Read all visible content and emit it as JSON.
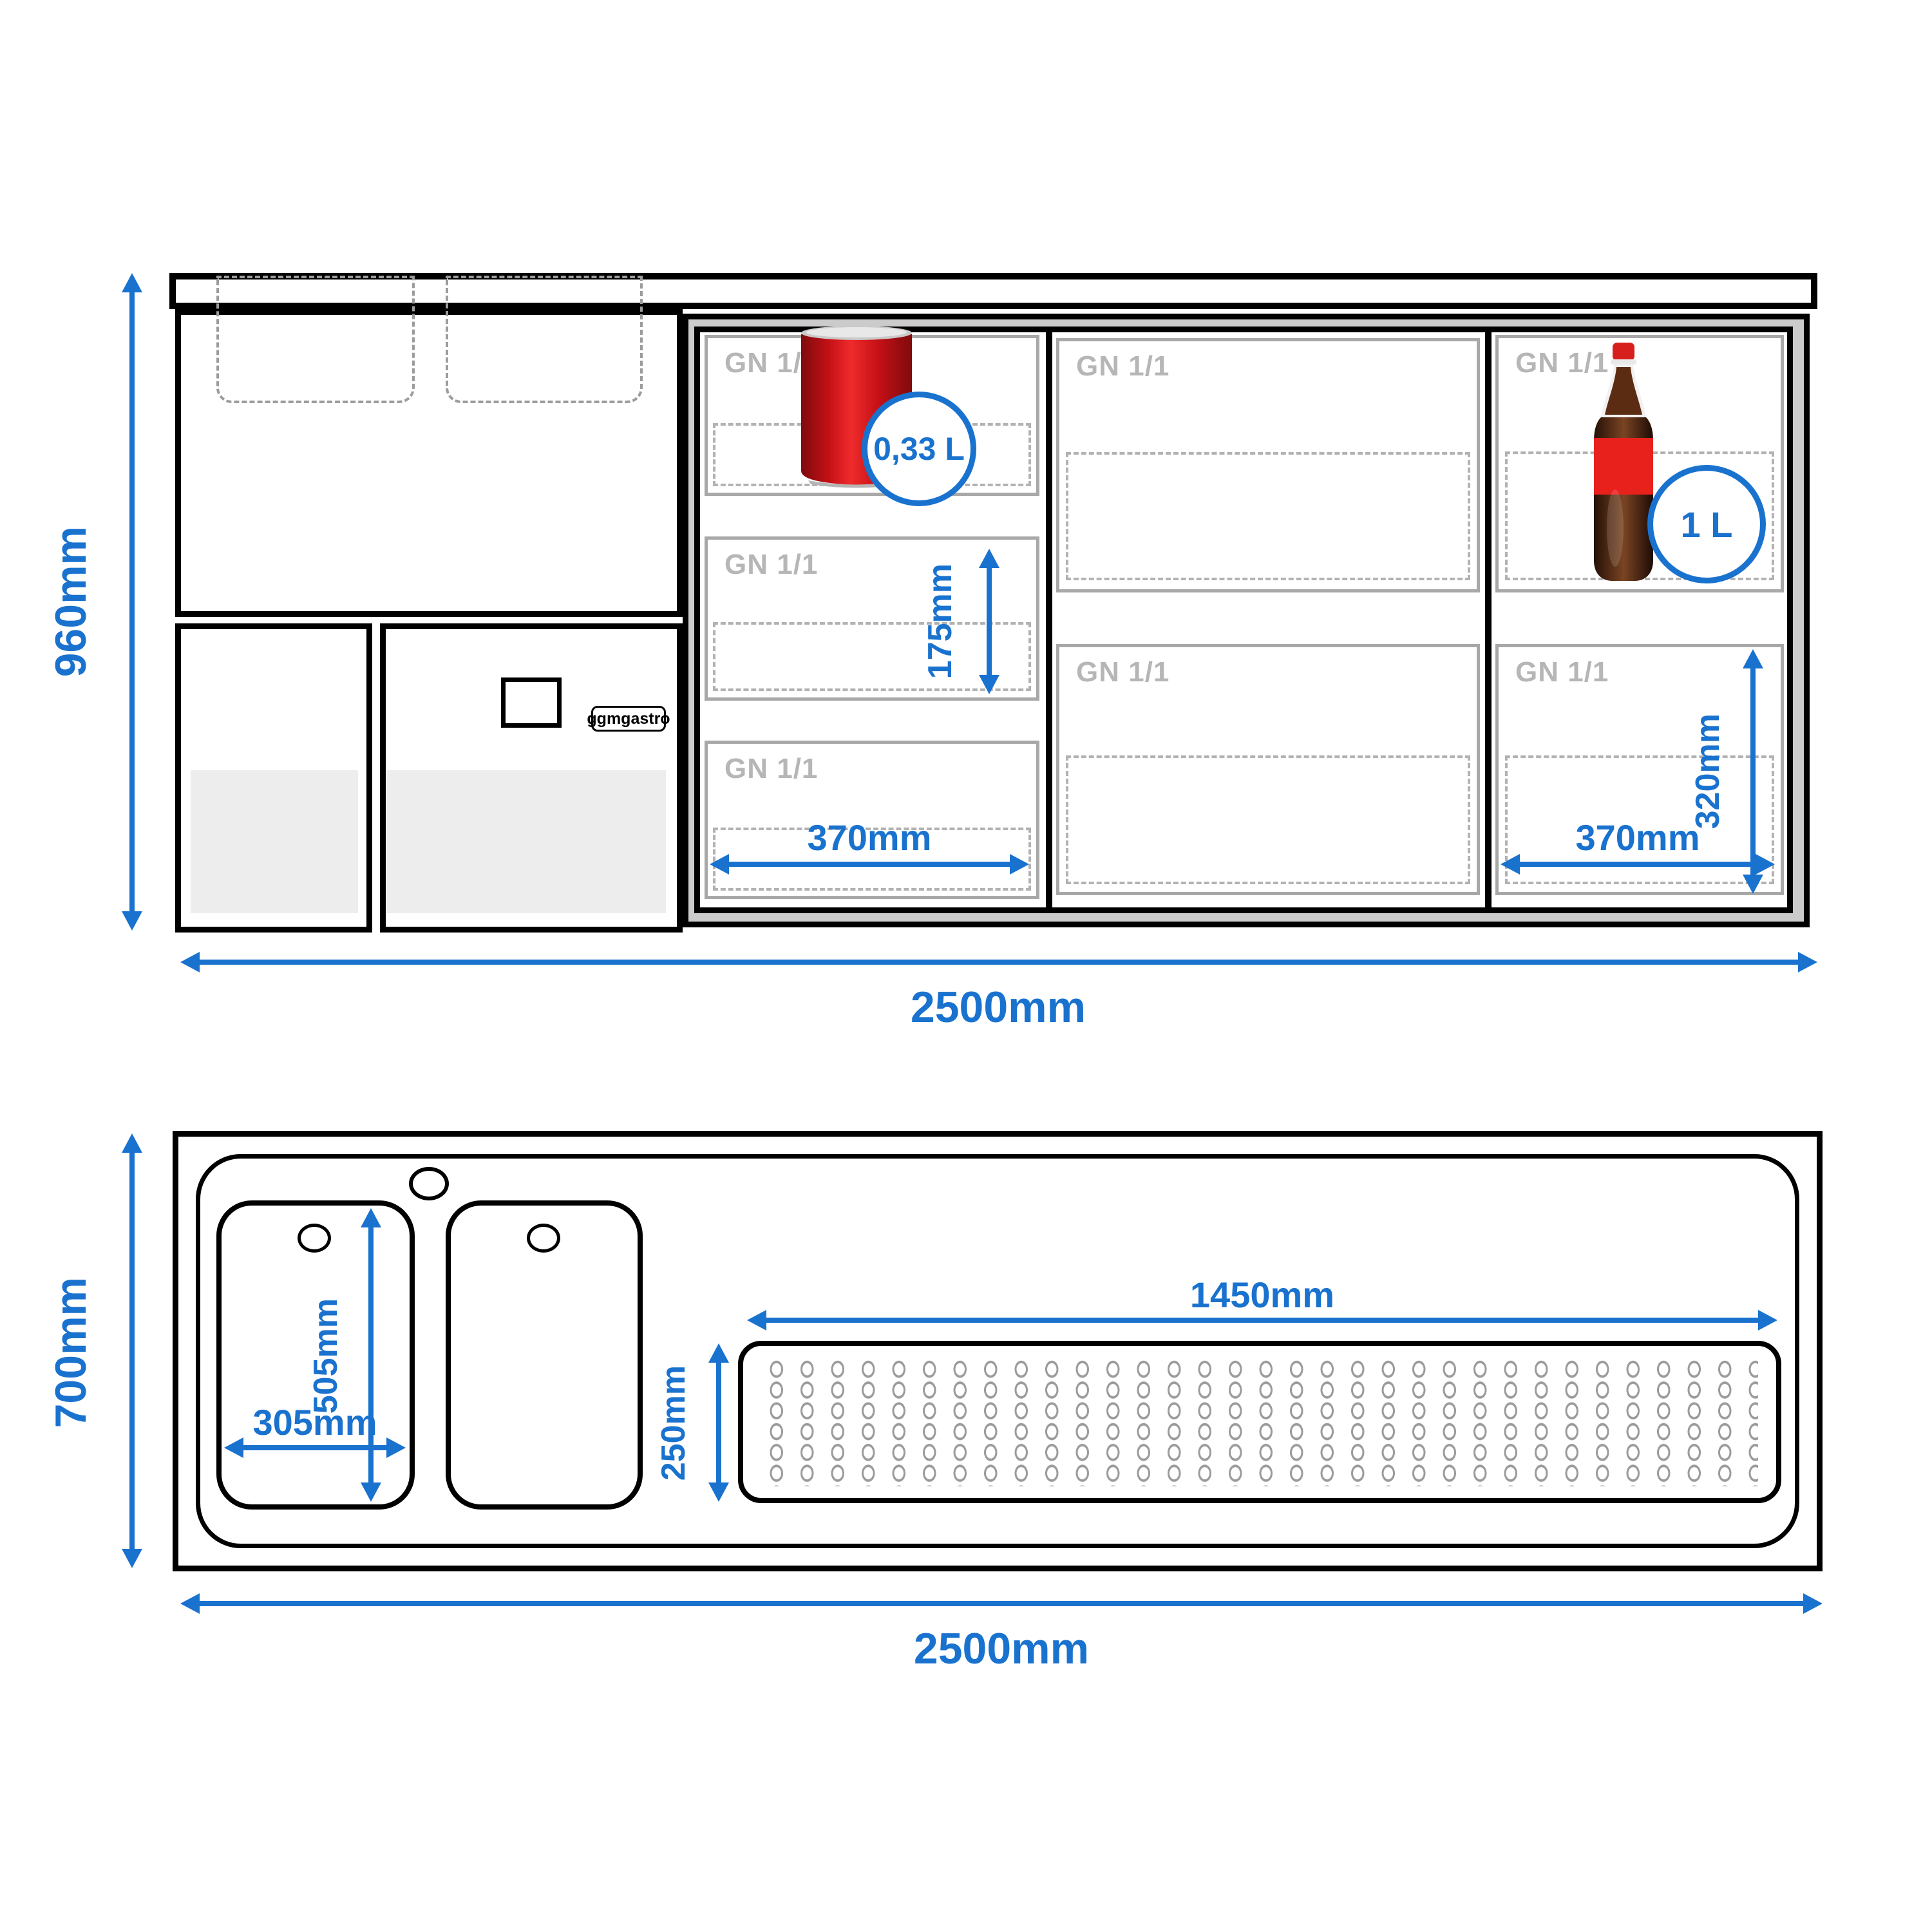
{
  "labels": {
    "gn_pan": "GN 1/1",
    "can_capacity": "0,33 L",
    "bottle_capacity": "1 L",
    "brand": "ggmgastro"
  },
  "top_view": {
    "height_label": "960mm",
    "width_label": "2500mm",
    "shelf_height_label": "175mm",
    "pan_width_left_label": "370mm",
    "pan_width_right_label": "370mm",
    "compartment_height_label": "320mm"
  },
  "bottom_view": {
    "depth_label": "700mm",
    "width_label": "2500mm",
    "sink_length_label": "505mm",
    "sink_width_label": "305mm",
    "drainer_length_label": "1450mm",
    "drainer_width_label": "250mm"
  },
  "colors": {
    "accent_blue": "#1a72cf",
    "body_gray": "#cbcbcb",
    "compartment_border_gray": "#a8a8a8",
    "gn_label_gray": "#b6b6b6",
    "door_panel_gray": "#ededed",
    "can_red": "#d61a1f",
    "bottle_brown": "#50270f"
  }
}
